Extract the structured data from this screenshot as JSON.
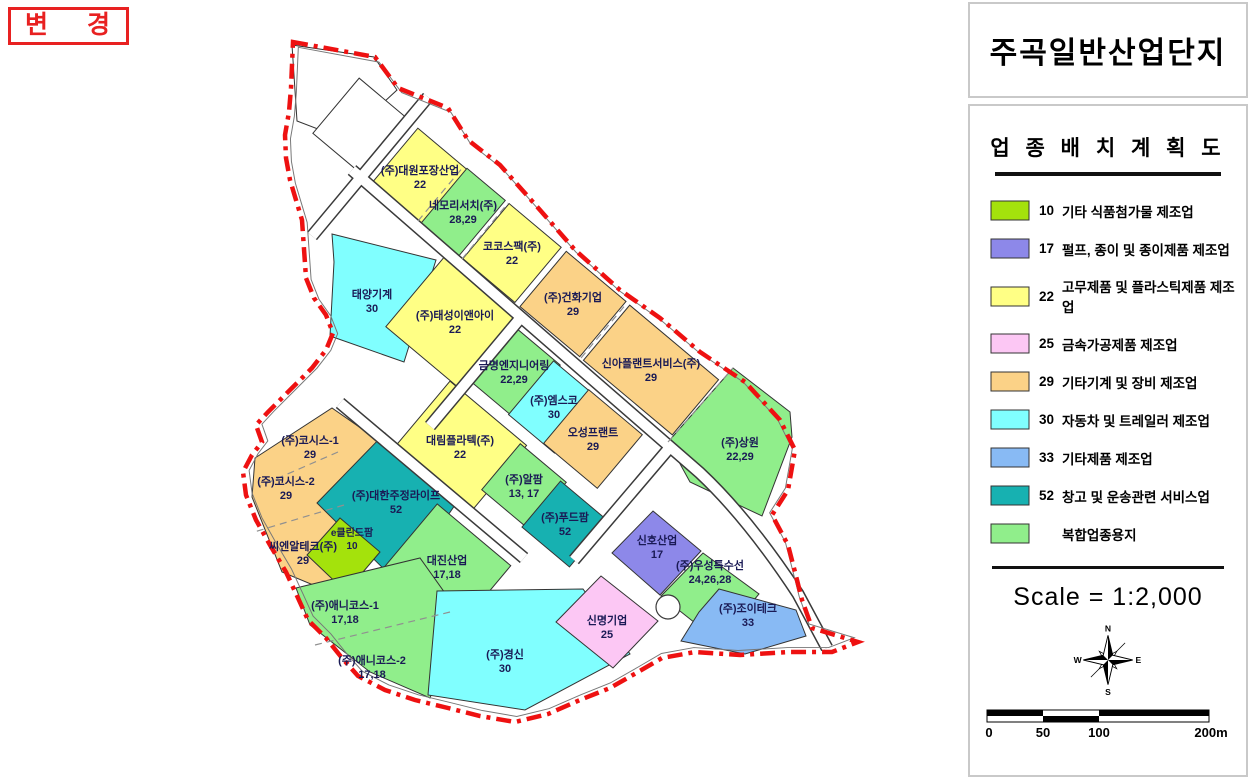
{
  "stamp": {
    "label": "변 경"
  },
  "title_panel": {
    "title": "주곡일반산업단지"
  },
  "legend_panel": {
    "title": "업 종 배 치 계 획 도",
    "items": [
      {
        "code": "10",
        "label": "기타 식품첨가물 제조업",
        "color": "#a4e20c"
      },
      {
        "code": "17",
        "label": "펄프, 종이 및 종이제품 제조업",
        "color": "#8d88e9"
      },
      {
        "code": "22",
        "label": "고무제품 및 플라스틱제품 제조업",
        "color": "#ffff85"
      },
      {
        "code": "25",
        "label": "금속가공제품 제조업",
        "color": "#fcc7f4"
      },
      {
        "code": "29",
        "label": "기타기계 및 장비 제조업",
        "color": "#fbd287"
      },
      {
        "code": "30",
        "label": "자동차 및 트레일러 제조업",
        "color": "#80ffff"
      },
      {
        "code": "33",
        "label": "기타제품 제조업",
        "color": "#88baf4"
      },
      {
        "code": "52",
        "label": "창고 및 운송관련 서비스업",
        "color": "#17b1b1"
      },
      {
        "code": "",
        "label": "복합업종용지",
        "color": "#90ee8b"
      }
    ],
    "scale_text": "Scale = 1:2,000",
    "compass": {
      "n": "N",
      "e": "E",
      "s": "S",
      "w": "W"
    },
    "scalebar": {
      "ticks": [
        "0",
        "50",
        "100",
        "200m"
      ]
    }
  },
  "map": {
    "boundary_color": "#ee1111",
    "parcels": [
      {
        "name": "(주)대원포장산업",
        "code": "22",
        "color": "#ffff85"
      },
      {
        "name": "네모리서치(주)",
        "code": "28,29",
        "color": "#90ee8b"
      },
      {
        "name": "코코스팩(주)",
        "code": "22",
        "color": "#ffff85"
      },
      {
        "name": "(주)건화기업",
        "code": "29",
        "color": "#fbd287"
      },
      {
        "name": "신아플랜트서비스(주)",
        "code": "29",
        "color": "#fbd287"
      },
      {
        "name": "태양기계",
        "code": "30",
        "color": "#80ffff"
      },
      {
        "name": "(주)태성이앤아이",
        "code": "22",
        "color": "#ffff85"
      },
      {
        "name": "금명엔지니어링",
        "code": "22,29",
        "color": "#90ee8b"
      },
      {
        "name": "(주)엠스코",
        "code": "30",
        "color": "#80ffff"
      },
      {
        "name": "대림플라텍(주)",
        "code": "22",
        "color": "#ffff85"
      },
      {
        "name": "오성프랜트",
        "code": "29",
        "color": "#fbd287"
      },
      {
        "name": "(주)알팜",
        "code": "13, 17",
        "color": "#90ee8b"
      },
      {
        "name": "(주)푸드팜",
        "code": "52",
        "color": "#17b1b1"
      },
      {
        "name": "(주)상원",
        "code": "22,29",
        "color": "#90ee8b"
      },
      {
        "name": "(주)코시스-1",
        "code": "29",
        "color": "#fbd287"
      },
      {
        "name": "(주)코시스-2",
        "code": "29",
        "color": "#fbd287"
      },
      {
        "name": "씨엔알테크(주)",
        "code": "29",
        "color": "#fbd287"
      },
      {
        "name": "(주)대한주정라이프",
        "code": "52",
        "color": "#17b1b1"
      },
      {
        "name": "e클린드팜",
        "code": "10",
        "color": "#a4e20c"
      },
      {
        "name": "대진산업",
        "code": "17,18",
        "color": "#90ee8b"
      },
      {
        "name": "(주)애니코스-1",
        "code": "17,18",
        "color": "#90ee8b"
      },
      {
        "name": "(주)애니코스-2",
        "code": "17,18",
        "color": "#90ee8b"
      },
      {
        "name": "(주)경신",
        "code": "30",
        "color": "#80ffff"
      },
      {
        "name": "신명기업",
        "code": "25",
        "color": "#fcc7f4"
      },
      {
        "name": "신호산업",
        "code": "17",
        "color": "#8d88e9"
      },
      {
        "name": "(주)우성특수선",
        "code": "24,26,28",
        "color": "#90ee8b"
      },
      {
        "name": "(주)조이테크",
        "code": "33",
        "color": "#88baf4"
      }
    ]
  }
}
